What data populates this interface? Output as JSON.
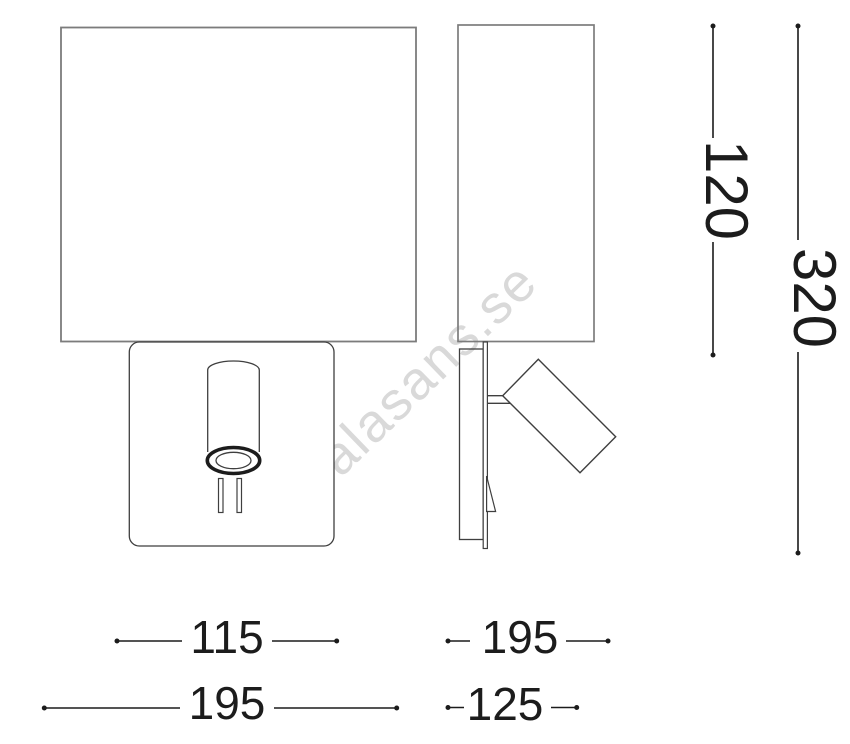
{
  "canvas": {
    "width": 850,
    "height": 744
  },
  "drawing": {
    "description": "Technical dimension drawing of a wall lamp with reading spotlight, front view and side view"
  },
  "watermark": {
    "text": "alasans.se"
  },
  "colors": {
    "outline": "#7c7c7c",
    "detail": "#3f3f3f",
    "dimension": "#1c1c1c",
    "watermark": "#d9d9d9",
    "background": "#ffffff"
  },
  "dimensions": {
    "bottom_left_inner": {
      "value": "115"
    },
    "bottom_left_outer": {
      "value": "195"
    },
    "bottom_right_upper": {
      "value": "195"
    },
    "bottom_right_lower": {
      "value": "125"
    },
    "right_inner": {
      "value": "120"
    },
    "right_outer": {
      "value": "320"
    }
  }
}
